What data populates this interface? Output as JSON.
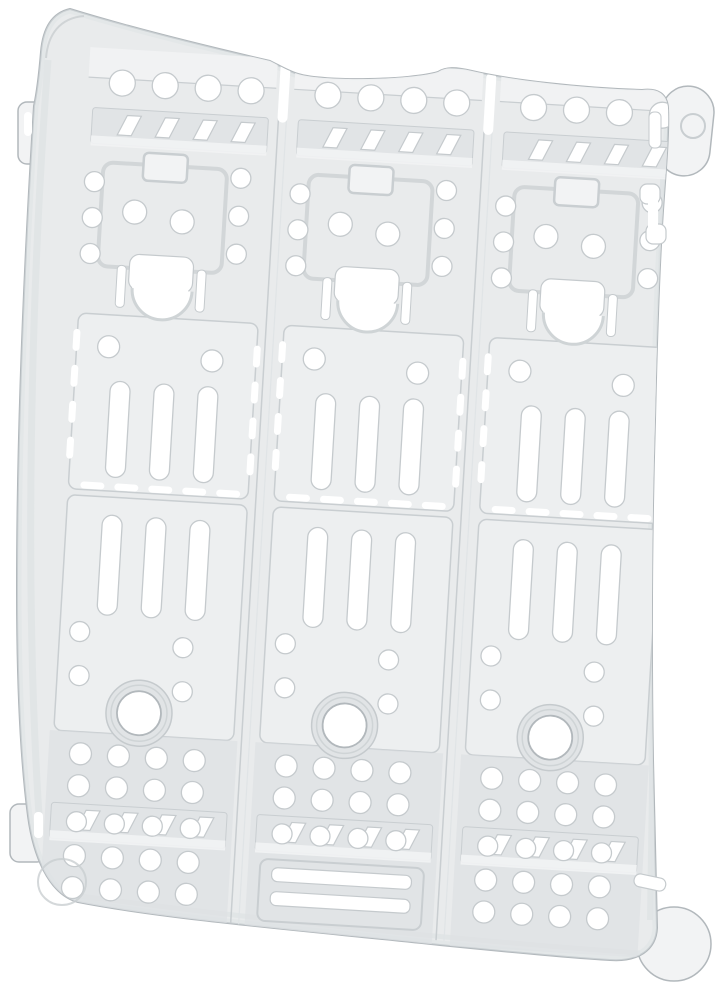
{
  "page": {
    "background": "#ffffff",
    "description": "Isometric CAD-style render of a translucent plastic three-gang perforated mounting plate on a white background"
  },
  "illustration": {
    "name": "clear-perforated-mounting-plate",
    "description": "Translucent three-section mounting plate with perforation holes, vent slots, latch plates, break-off slotted panels and edge tabs",
    "colors": {
      "background": "#ffffff",
      "body": "#e9ebec",
      "body_light": "#f2f3f4",
      "panel": "#edeff0",
      "body_shade": "#e1e4e6",
      "band_shade": "#dde1e3",
      "edge": "#b2b8bc",
      "edge_soft": "#c9ced1",
      "groove": "#cfd4d6",
      "inner_highlight": "#dfe3e5",
      "hole": "#ffffff",
      "hole_edge": "#c5cacd"
    },
    "structure": {
      "columns": 3,
      "top_holes_per_column": 4,
      "hatch_slots_per_column": 4,
      "latch_holes_per_column": 2,
      "side_holes_per_side": 3,
      "upper_panel_slots": 3,
      "lower_panel_slots": 3,
      "upper_panel_corner_holes": 2,
      "lower_panel_small_holes": 4,
      "large_boss_holes_per_column": 1,
      "bottom_grid_cols": 4,
      "bottom_grid_rows": 5,
      "center_bottom_slots": 2,
      "edge_dashes_left": 4,
      "edge_dashes_right": 4,
      "edge_dashes_bottom": 5,
      "side_features": [
        "left-top-notch-tab",
        "right-top-pill-knob",
        "right-edge-bone-cutout",
        "left-bottom-tab",
        "bottom-right-knob"
      ]
    },
    "tilt_degrees": 3.4
  }
}
